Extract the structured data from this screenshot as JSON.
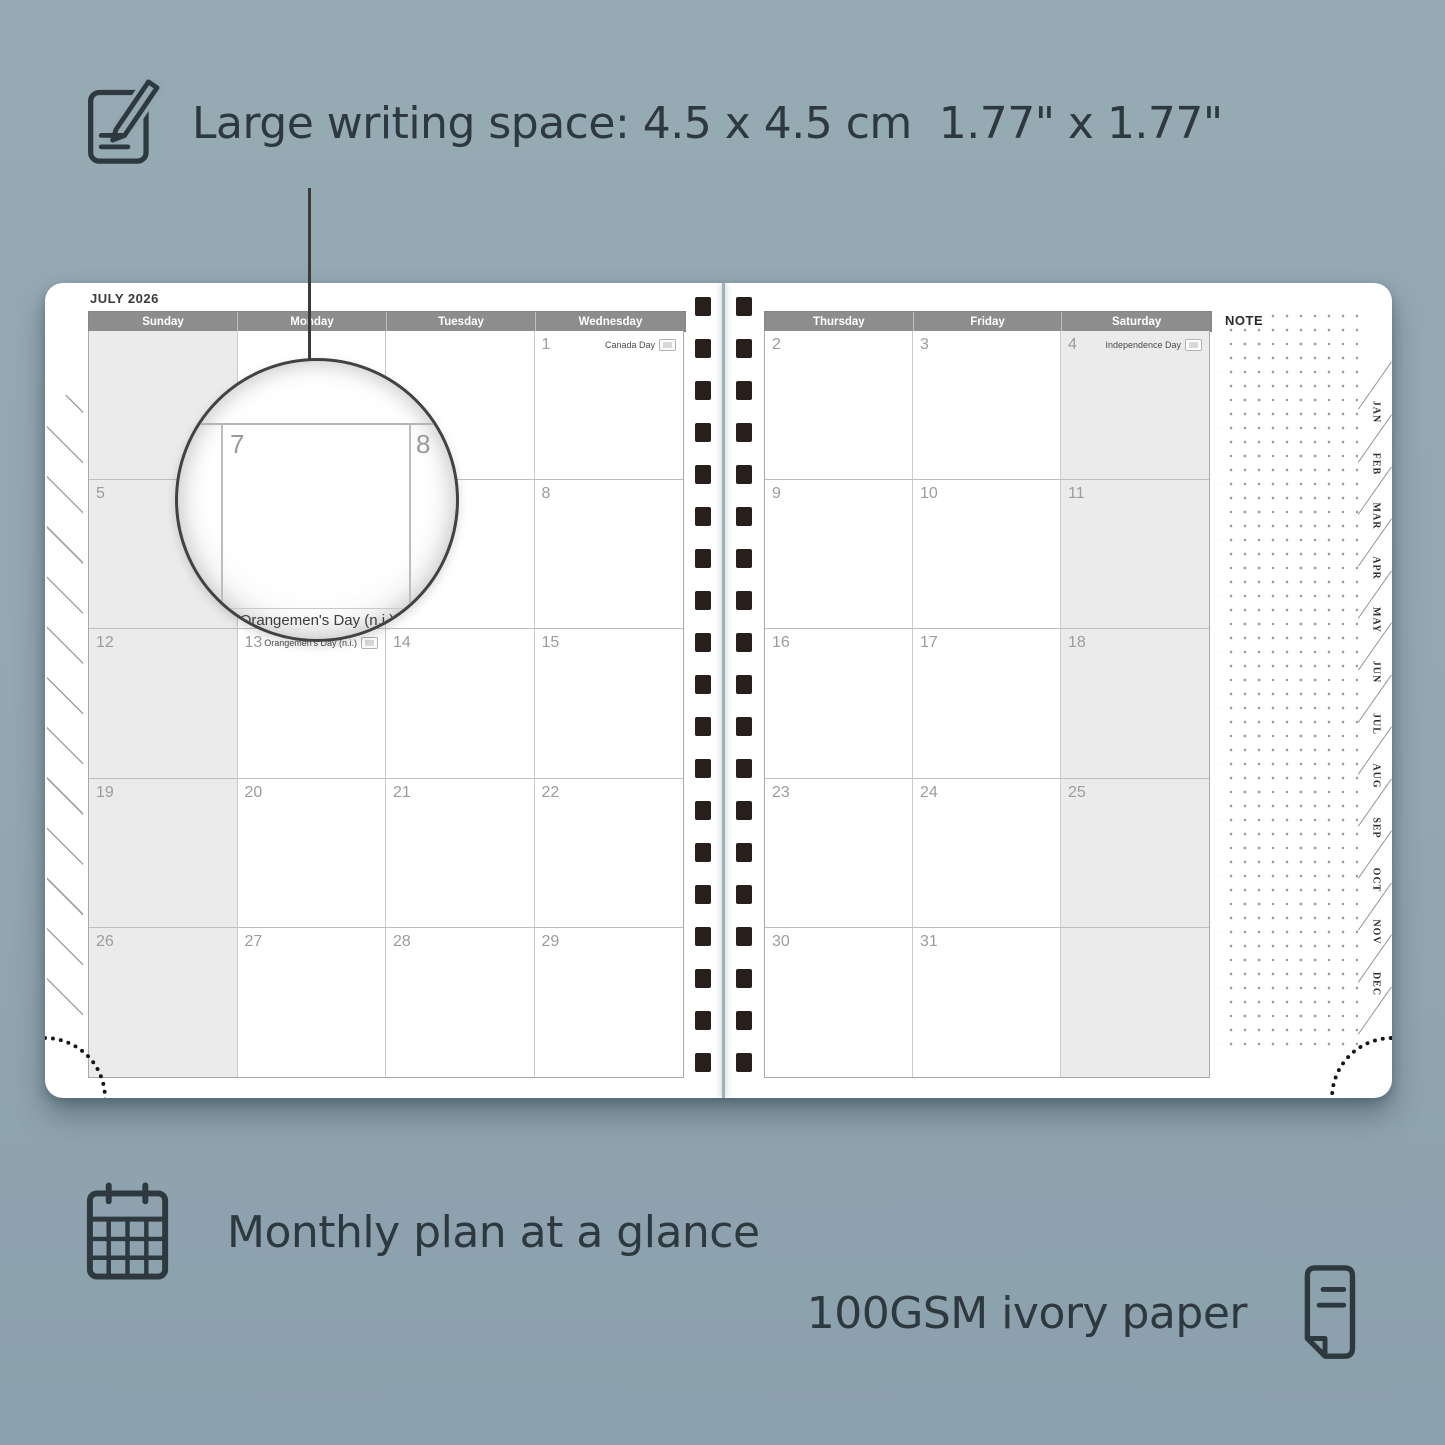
{
  "colors": {
    "background": "#93a7b1",
    "ink": "#2d393e",
    "header_bar": "#8d8d8d",
    "weekend_shade": "#ebebeb",
    "spiral_hole": "#281f1d",
    "page": "#ffffff"
  },
  "icons": {
    "writing_space": "pencil-note-icon",
    "monthly_plan": "calendar-grid-icon",
    "paper": "paper-sheet-icon"
  },
  "features": {
    "writing_space": "Large writing space: 4.5 x 4.5 cm  1.77\" x 1.77\"",
    "monthly_plan": "Monthly plan at a glance",
    "paper": "100GSM ivory paper"
  },
  "planner": {
    "month_title": "JULY 2026",
    "note_label": "NOTE",
    "weekday_headers_left": [
      "Sunday",
      "Monday",
      "Tuesday",
      "Wednesday"
    ],
    "weekday_headers_right": [
      "Thursday",
      "Friday",
      "Saturday"
    ],
    "month_tabs": [
      "JAN",
      "FEB",
      "MAR",
      "APR",
      "MAY",
      "JUN",
      "JUL",
      "AUG",
      "SEP",
      "OCT",
      "NOV",
      "DEC"
    ],
    "left_page_cells": [
      [
        {
          "day": ""
        },
        {
          "day": ""
        },
        {
          "day": ""
        },
        {
          "day": "1",
          "event": "Canada Day",
          "flag": true
        }
      ],
      [
        {
          "day": "5"
        },
        {
          "day": "6"
        },
        {
          "day": "7"
        },
        {
          "day": "8"
        }
      ],
      [
        {
          "day": "12"
        },
        {
          "day": "13",
          "event": "Orangemen's Day (n.i.)",
          "flag": true
        },
        {
          "day": "14"
        },
        {
          "day": "15"
        }
      ],
      [
        {
          "day": "19"
        },
        {
          "day": "20"
        },
        {
          "day": "21"
        },
        {
          "day": "22"
        }
      ],
      [
        {
          "day": "26"
        },
        {
          "day": "27"
        },
        {
          "day": "28"
        },
        {
          "day": "29"
        }
      ]
    ],
    "right_page_cells": [
      [
        {
          "day": "2"
        },
        {
          "day": "3"
        },
        {
          "day": "4",
          "event": "Independence Day",
          "flag": true
        }
      ],
      [
        {
          "day": "9"
        },
        {
          "day": "10"
        },
        {
          "day": "11"
        }
      ],
      [
        {
          "day": "16"
        },
        {
          "day": "17"
        },
        {
          "day": "18"
        }
      ],
      [
        {
          "day": "23"
        },
        {
          "day": "24"
        },
        {
          "day": "25"
        }
      ],
      [
        {
          "day": "30"
        },
        {
          "day": "31"
        },
        {
          "day": ""
        }
      ]
    ],
    "magnifier": {
      "left_day": "7",
      "right_day": "8",
      "event_caption": "Orangemen's Day (n.i.)"
    }
  }
}
